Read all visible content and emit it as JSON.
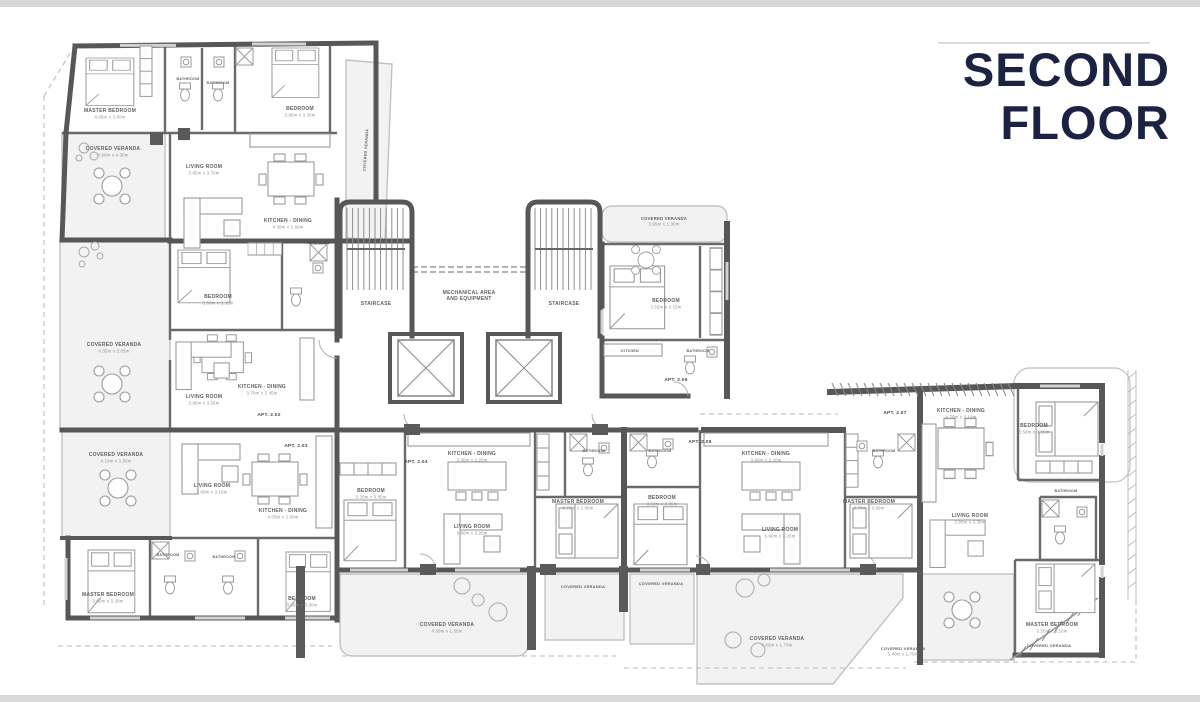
{
  "title": {
    "line1": "SECOND",
    "line2": "FLOOR"
  },
  "colors": {
    "title_text": "#1c2342",
    "main_walls": "#575757",
    "partitions": "#6a6a6a",
    "veranda_fill": "#f2f2f2",
    "light_lines": "#c2c2c2",
    "room_label": "#616161",
    "dim_label": "#8c8c8c"
  },
  "plan": {
    "rooms": [
      {
        "label": "MASTER BEDROOM",
        "dim": "4.05m x 3.60m",
        "x": 110,
        "y": 112
      },
      {
        "label": "BATHROOM",
        "x": 188,
        "y": 80,
        "s": 3.6
      },
      {
        "label": "BATHROOM",
        "x": 218,
        "y": 84,
        "s": 3.6
      },
      {
        "label": "BEDROOM",
        "dim": "3.85m x 3.30m",
        "x": 300,
        "y": 110
      },
      {
        "label": "COVERED VERANDA",
        "dim": "4.90m x 4.30m",
        "x": 113,
        "y": 150
      },
      {
        "label": "LIVING ROOM",
        "dim": "3.85m x 3.70m",
        "x": 204,
        "y": 168
      },
      {
        "label": "KITCHEN - DINING",
        "dim": "4.30m x 2.60m",
        "x": 288,
        "y": 222
      },
      {
        "label": "COVERED VERANDA",
        "x": 367,
        "y": 150,
        "s": 3.8,
        "r": -86
      },
      {
        "label": "BEDROOM",
        "dim": "3.60m x 3.35m",
        "x": 218,
        "y": 298
      },
      {
        "label": "COVERED VERANDA",
        "dim": "4.35m x 3.05m",
        "x": 114,
        "y": 346
      },
      {
        "label": "LIVING ROOM",
        "dim": "3.85m x 3.55m",
        "x": 204,
        "y": 398
      },
      {
        "label": "KITCHEN - DINING",
        "dim": "3.70m x 2.45m",
        "x": 262,
        "y": 388
      },
      {
        "label": "STAIRCASE",
        "x": 376,
        "y": 305
      },
      {
        "label": "STAIRCASE",
        "x": 564,
        "y": 305
      },
      {
        "label": "MECHANICAL AREA",
        "label2": "AND EQUIPMENT",
        "x": 469,
        "y": 294
      },
      {
        "label": "COVERED VERANDA",
        "dim": "3.95m x 1.30m",
        "x": 664,
        "y": 220,
        "s": 4.2
      },
      {
        "label": "BEDROOM",
        "dim": "3.55m x 3.15m",
        "x": 666,
        "y": 302
      },
      {
        "label": "KITCHEN",
        "x": 630,
        "y": 352,
        "s": 3.6
      },
      {
        "label": "BATHROOM",
        "x": 698,
        "y": 352,
        "s": 3.6
      },
      {
        "label": "COVERED VERANDA",
        "dim": "4.10m x 3.50m",
        "x": 116,
        "y": 456
      },
      {
        "label": "LIVING ROOM",
        "dim": "3.60m x 3.10m",
        "x": 212,
        "y": 487
      },
      {
        "label": "KITCHEN - DINING",
        "dim": "4.05m x 2.00m",
        "x": 283,
        "y": 512
      },
      {
        "label": "MASTER BEDROOM",
        "dim": "3.60m x 3.20m",
        "x": 108,
        "y": 596
      },
      {
        "label": "BATHROOM",
        "x": 168,
        "y": 556,
        "s": 3.6
      },
      {
        "label": "BATHROOM",
        "x": 224,
        "y": 558,
        "s": 3.6
      },
      {
        "label": "BEDROOM",
        "dim": "3.30m x 3.00m",
        "x": 302,
        "y": 600
      },
      {
        "label": "BEDROOM",
        "dim": "3.30m x 3.05m",
        "x": 371,
        "y": 492
      },
      {
        "label": "KITCHEN - DINING",
        "dim": "3.90m x 2.20m",
        "x": 472,
        "y": 455
      },
      {
        "label": "LIVING ROOM",
        "dim": "3.90m x 3.20m",
        "x": 472,
        "y": 528
      },
      {
        "label": "BATHROOM",
        "x": 594,
        "y": 452,
        "s": 3.6
      },
      {
        "label": "MASTER BEDROOM",
        "dim": "3.70m x 3.00m",
        "x": 578,
        "y": 503
      },
      {
        "label": "COVERED VERANDA",
        "dim": "4.30m x 1.55m",
        "x": 447,
        "y": 626
      },
      {
        "label": "COVERED VERANDA",
        "x": 583,
        "y": 588,
        "s": 4
      },
      {
        "label": "BATHROOM",
        "x": 660,
        "y": 452,
        "s": 3.6
      },
      {
        "label": "BEDROOM",
        "dim": "3.30m x 3.05m",
        "x": 662,
        "y": 499
      },
      {
        "label": "KITCHEN - DINING",
        "dim": "3.90m x 2.20m",
        "x": 766,
        "y": 455
      },
      {
        "label": "LIVING ROOM",
        "dim": "3.90m x 3.20m",
        "x": 780,
        "y": 531
      },
      {
        "label": "BATHROOM",
        "x": 884,
        "y": 452,
        "s": 3.6
      },
      {
        "label": "MASTER BEDROOM",
        "dim": "3.70m x 3.00m",
        "x": 869,
        "y": 503
      },
      {
        "label": "COVERED VERANDA",
        "x": 661,
        "y": 585,
        "s": 4
      },
      {
        "label": "COVERED VERANDA",
        "dim": "4.65m x 1.70m",
        "x": 777,
        "y": 640
      },
      {
        "label": "KITCHEN - DINING",
        "dim": "4.75m x 3.10m",
        "x": 961,
        "y": 412
      },
      {
        "label": "BEDROOM",
        "dim": "3.50m x 3.15m",
        "x": 1034,
        "y": 427
      },
      {
        "label": "LIVING ROOM",
        "dim": "3.80m x 3.30m",
        "x": 970,
        "y": 517
      },
      {
        "label": "BATHROOM",
        "x": 1066,
        "y": 492,
        "s": 3.6
      },
      {
        "label": "MASTER BEDROOM",
        "dim": "3.55m x 3.10m",
        "x": 1052,
        "y": 626
      },
      {
        "label": "COVERED VERANDA",
        "x": 1049,
        "y": 647,
        "s": 4
      },
      {
        "label": "COVERED VERANDA",
        "dim": "3.40m x 1.75m",
        "x": 903,
        "y": 650,
        "s": 4
      }
    ],
    "apartments": [
      {
        "label": "APT. 2.01",
        "x": 318,
        "y": 244
      },
      {
        "label": "APT. 2.02",
        "x": 269,
        "y": 416
      },
      {
        "label": "APT. 2.03",
        "x": 296,
        "y": 447
      },
      {
        "label": "APT. 2.04",
        "x": 416,
        "y": 463
      },
      {
        "label": "APT. 2.05",
        "x": 676,
        "y": 381
      },
      {
        "label": "APT. 2.06",
        "x": 700,
        "y": 443
      },
      {
        "label": "APT. 2.07",
        "x": 895,
        "y": 414
      }
    ]
  }
}
